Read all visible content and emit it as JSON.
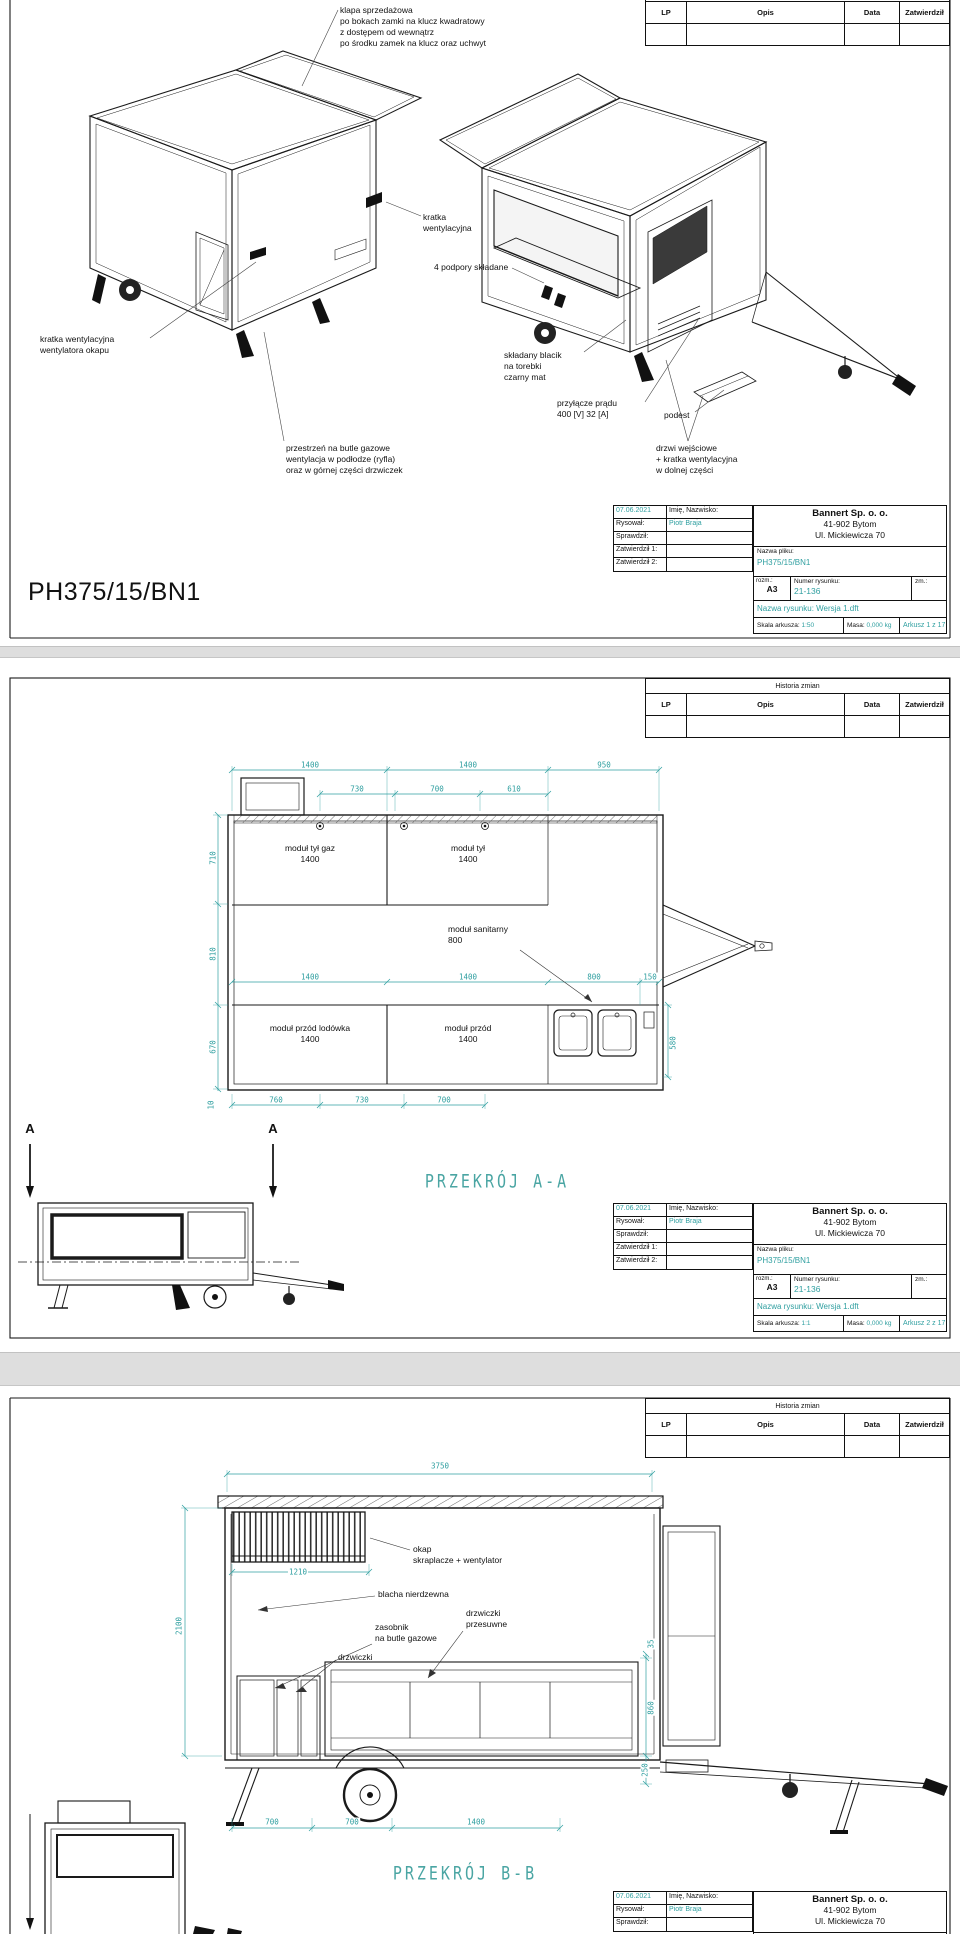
{
  "colors": {
    "accent_teal": "#2f9fa0",
    "line": "#1a1a1a",
    "paper": "#ffffff",
    "background": "#e2e2e2"
  },
  "revision": {
    "title": "Historia zmian",
    "col_lp": "LP",
    "col_opis": "Opis",
    "col_data": "Data",
    "col_zatw": "Zatwierdził"
  },
  "titleblock": {
    "date": "07.06.2021",
    "name_header": "Imię, Nazwisko:",
    "rysowal_label": "Rysował:",
    "rysowal_value": "Piotr Braja",
    "sprawdzil_label": "Sprawdził:",
    "zatw1_label": "Zatwierdził 1:",
    "zatw2_label": "Zatwierdził 2:",
    "company_name": "Bannert Sp. o. o.",
    "company_addr1": "41-902 Bytom",
    "company_addr2": "Ul. Mickiewicza 70",
    "file_label": "Nazwa pliku:",
    "file_value": "PH375/15/BN1",
    "size_label": "rozm.:",
    "size_value": "A3",
    "number_label": "Numer rysunku:",
    "number_value": "21-136",
    "zm_label": "zm.:",
    "drawing_name": "Nazwa rysunku: Wersja 1.dft",
    "scale_label": "Skala arkusza:",
    "mass_label": "Masa:",
    "mass_value": "0,000 kg"
  },
  "sheet1": {
    "scale_value": "1:50",
    "arkusz_value": "Arkusz 1 z 17",
    "part_code": "PH375/15/BN1",
    "ann": {
      "klapa": "klapa sprzedażowa\npo bokach zamki na klucz kwadratowy\nz dostępem od wewnątrz\npo środku zamek na klucz oraz uchwyt",
      "kratka": "kratka\nwentylacyjna",
      "podpory": "4 podpory składane",
      "kratka_okap": "kratka wentylacyjna\nwentylatora okapu",
      "blacik": "składany blacik\nna torebki\nczarny mat",
      "przylacze": "przyłącze prądu\n400 [V] 32 [A]",
      "podest": "podest",
      "przestrzen": "przestrzeń na butle gazowe\nwentylacja w podłodze (ryfla)\noraz w górnej części drzwiczek",
      "drzwi": "drzwi wejściowe\n+ kratka wentylacyjna\nw dolnej części"
    }
  },
  "sheet2": {
    "scale_value": "1:1",
    "arkusz_value": "Arkusz 2 z 17",
    "section_title": "PRZEKRÓJ A-A",
    "marker": "A",
    "modules": {
      "tyl_gaz": "moduł tył gaz\n1400",
      "tyl": "moduł tył\n1400",
      "sanitarny": "moduł sanitarny\n800",
      "przod_lodowka": "moduł przód lodówka\n1400",
      "przod": "moduł przód\n1400"
    },
    "dims": {
      "top": [
        "1400",
        "1400",
        "950"
      ],
      "top2": [
        "730",
        "700",
        "610"
      ],
      "left": [
        "710",
        "810",
        "670",
        "10"
      ],
      "mid": [
        "1400",
        "1400",
        "800",
        "150"
      ],
      "right": "580",
      "bottom": [
        "760",
        "730",
        "700"
      ]
    }
  },
  "sheet3": {
    "section_title": "PRZEKRÓJ B-B",
    "ann": {
      "okap": "okap\nskraplacze + wentylator",
      "blacha": "blacha nierdzewna",
      "zasobnik": "zasobnik\nna butle gazowe",
      "drzwiczki": "drzwiczki",
      "przesuwne": "drzwiczki\nprzesuwne"
    },
    "dims": {
      "total": "3750",
      "okap_width": "1210",
      "height": "2100",
      "right": [
        "35",
        "860",
        "250"
      ],
      "bottom": [
        "700",
        "700",
        "1400"
      ]
    }
  }
}
